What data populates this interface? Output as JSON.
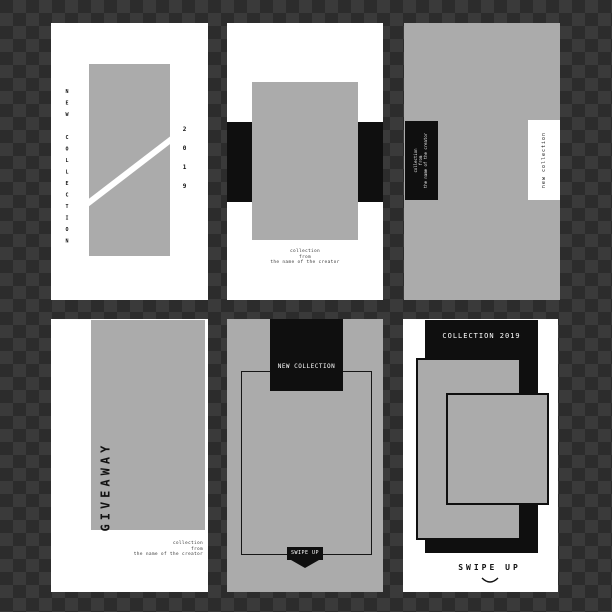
{
  "palette": {
    "checker_dark": "#2c2c2c",
    "checker_light": "#3a3a3a",
    "card_white": "#ffffff",
    "card_gray": "#ababab",
    "ink_black": "#0f0f0f"
  },
  "cards": {
    "c1": {
      "title": "NEW COLLECTION",
      "year": "2019"
    },
    "c2": {
      "caption": [
        "collection",
        "from",
        "the name of the creator"
      ]
    },
    "c3": {
      "dark_caption": [
        "collection",
        "from",
        "the name of the creator"
      ],
      "light_label": "new collection"
    },
    "c4": {
      "title": "GIVEAWAY",
      "caption": [
        "collection",
        "from",
        "the name of the creator"
      ]
    },
    "c5": {
      "header": "NEW COLLECTION",
      "swipe_label": "SWIPE UP"
    },
    "c6": {
      "header": "COLLECTION 2019",
      "swipe_label": "SWIPE UP"
    }
  }
}
